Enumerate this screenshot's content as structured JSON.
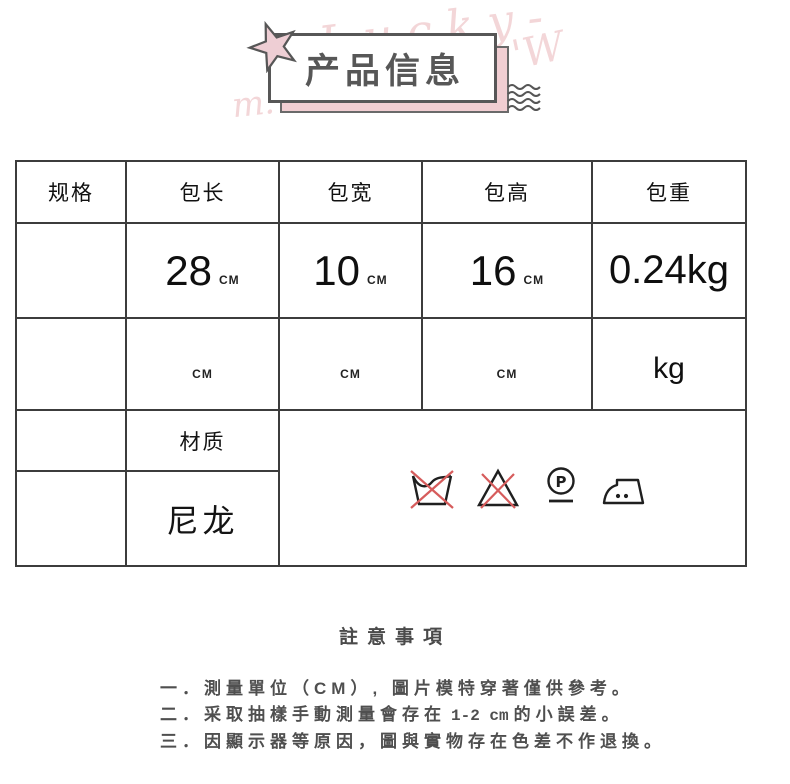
{
  "header": {
    "title": "产品信息",
    "decor": {
      "script1": "Lucky-",
      "script2": "'W",
      "script3": "m:"
    },
    "colors": {
      "pink_fill": "#f1ced2",
      "outline": "#575757",
      "red_cross": "#d65c5c"
    }
  },
  "table": {
    "headers": [
      "规格",
      "包长",
      "包宽",
      "包高",
      "包重"
    ],
    "row_values": {
      "length": "28",
      "length_unit": "CM",
      "width": "10",
      "width_unit": "CM",
      "height": "16",
      "height_unit": "CM",
      "weight": "0.24kg"
    },
    "row_units": {
      "length_unit": "CM",
      "width_unit": "CM",
      "height_unit": "CM",
      "weight_unit": "kg"
    },
    "material_label": "材质",
    "material_value": "尼龙",
    "care_symbols": [
      "do-not-wash",
      "do-not-bleach",
      "dry-clean-P",
      "iron-two-dots"
    ]
  },
  "notes": {
    "title": "註意事項",
    "item1": "一．測量單位（CM）, 圖片模特穿著僅供參考。",
    "item2_a": "二．采取抽樣手動測量會存在",
    "item2_b": "1-2 cm",
    "item2_c": "的小誤差。",
    "item3": "三．因顯示器等原因，圖與實物存在色差不作退換。"
  }
}
